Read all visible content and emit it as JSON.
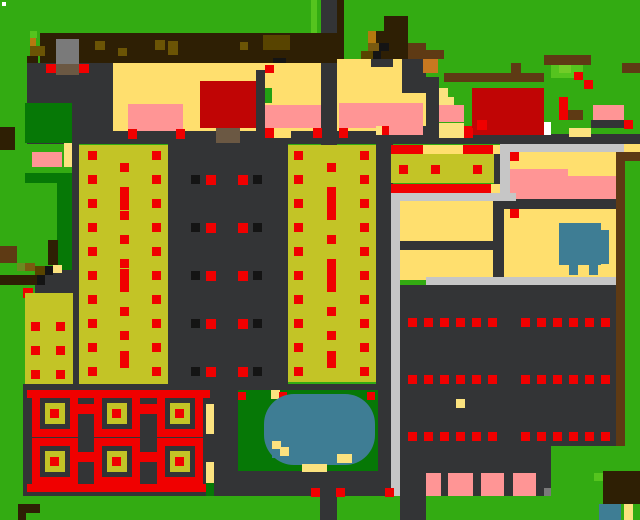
{
  "meta": {
    "kind": "pixel-farm-game-map",
    "width": 640,
    "height": 520
  },
  "palette": {
    "G": "#33AB12",
    "LG": "#55C41E",
    "LG2": "#72CC28",
    "GRN2": "#22A012",
    "DG": "#067806",
    "K": "#333436",
    "GRY": "#7A7A7A",
    "LGY": "#C6C6C6",
    "W": "#FFFFFF",
    "BK": "#141414",
    "Y": "#FFDF6E",
    "TAN": "#FBE27F",
    "O": "#C3C426",
    "OD2": "#584400",
    "OG": "#6B8A20",
    "P": "#FF9595",
    "R": "#F00000",
    "DR": "#C00505",
    "BD": "#2E1F04",
    "BR": "#5E3A14",
    "BM": "#6B5405",
    "BM2": "#7A5A10",
    "ORL": "#B5790F",
    "OR": "#C87820",
    "BAR": "#6B5843",
    "BL": "#3E7D94"
  },
  "rects": [
    [
      0,
      0,
      640,
      520,
      "G",
      "grass-background"
    ],
    [
      2,
      2,
      4,
      4,
      "W",
      "speck-white"
    ],
    [
      311,
      0,
      6,
      33,
      "LG",
      "light-grass-stripe"
    ],
    [
      321,
      0,
      16,
      146,
      "K",
      "road-vertical-top"
    ],
    [
      337,
      0,
      7,
      66,
      "BD",
      "trunk-strip"
    ],
    [
      40,
      33,
      297,
      30,
      "BD",
      "tilled-dirt-band"
    ],
    [
      30,
      31,
      7,
      7,
      "LG",
      "grass-speck"
    ],
    [
      30,
      38,
      6,
      8,
      "ORL",
      "dirt-speck"
    ],
    [
      30,
      46,
      15,
      10,
      "BM",
      "dirt-speck"
    ],
    [
      27,
      56,
      11,
      7,
      "BD",
      "dirt-speck"
    ],
    [
      30,
      63,
      7,
      11,
      "BK",
      "dirt-speck"
    ],
    [
      95,
      41,
      10,
      9,
      "BM",
      "dirt-speck"
    ],
    [
      118,
      48,
      9,
      8,
      "BM",
      "dirt-speck"
    ],
    [
      155,
      40,
      10,
      10,
      "BM",
      "dirt-speck"
    ],
    [
      168,
      41,
      10,
      14,
      "BM",
      "dirt-speck"
    ],
    [
      240,
      42,
      8,
      8,
      "BM",
      "dirt-speck"
    ],
    [
      263,
      35,
      27,
      15,
      "OD2",
      "dirt-patch"
    ],
    [
      273,
      58,
      13,
      5,
      "BK",
      "dirt-speck"
    ],
    [
      0,
      127,
      15,
      23,
      "BD",
      "left-edge-stump"
    ],
    [
      27,
      63,
      86,
      80,
      "K",
      "yard-dark-left"
    ],
    [
      56,
      39,
      23,
      26,
      "GRY",
      "shipping-bin"
    ],
    [
      56,
      64,
      23,
      11,
      "BAR",
      "shipping-bin-front"
    ],
    [
      46,
      64,
      10,
      9,
      "R",
      "red-dot"
    ],
    [
      79,
      64,
      10,
      9,
      "R",
      "red-dot"
    ],
    [
      113,
      63,
      208,
      68,
      "Y",
      "farmhouse-floor"
    ],
    [
      337,
      59,
      89,
      72,
      "Y",
      "house-right-floor"
    ],
    [
      371,
      59,
      22,
      8,
      "K",
      "wall-notch"
    ],
    [
      402,
      59,
      24,
      34,
      "K",
      "wall-notch"
    ],
    [
      423,
      59,
      15,
      14,
      "OR",
      "orange-crate"
    ],
    [
      384,
      16,
      24,
      15,
      "BD",
      "tree-canopy"
    ],
    [
      376,
      31,
      32,
      12,
      "BD",
      "tree-canopy"
    ],
    [
      368,
      31,
      8,
      12,
      "ORL",
      "tree-branch"
    ],
    [
      368,
      43,
      11,
      8,
      "BM2",
      "tree-branch"
    ],
    [
      379,
      43,
      10,
      8,
      "BK",
      "tree-shadow"
    ],
    [
      389,
      43,
      19,
      8,
      "BD",
      "tree-canopy"
    ],
    [
      361,
      51,
      12,
      8,
      "OD2",
      "tree-branch"
    ],
    [
      373,
      51,
      8,
      8,
      "BK",
      "tree-shadow"
    ],
    [
      381,
      51,
      27,
      8,
      "BD",
      "tree-canopy"
    ],
    [
      408,
      43,
      18,
      16,
      "BR",
      "fence-segment"
    ],
    [
      426,
      50,
      18,
      9,
      "BR",
      "fence-segment"
    ],
    [
      200,
      81,
      56,
      47,
      "DR",
      "red-building"
    ],
    [
      256,
      70,
      9,
      71,
      "K",
      "interior-wall"
    ],
    [
      265,
      65,
      9,
      8,
      "R",
      "red-dot"
    ],
    [
      128,
      104,
      55,
      27,
      "P",
      "pink-rug"
    ],
    [
      265,
      105,
      56,
      23,
      "P",
      "pink-rug"
    ],
    [
      339,
      103,
      84,
      25,
      "P",
      "pink-rug"
    ],
    [
      265,
      88,
      7,
      15,
      "GRN2",
      "green-door"
    ],
    [
      27,
      131,
      399,
      13,
      "K",
      "houses-baseline"
    ],
    [
      216,
      128,
      24,
      15,
      "BAR",
      "doormat"
    ],
    [
      273,
      128,
      18,
      10,
      "Y",
      "threshold"
    ],
    [
      128,
      129,
      9,
      10,
      "R",
      "red-dot"
    ],
    [
      176,
      129,
      9,
      10,
      "R",
      "red-dot"
    ],
    [
      265,
      128,
      9,
      10,
      "R",
      "red-dot"
    ],
    [
      313,
      128,
      9,
      10,
      "R",
      "red-dot"
    ],
    [
      339,
      128,
      9,
      10,
      "R",
      "red-dot"
    ],
    [
      386,
      128,
      9,
      10,
      "R",
      "red-dot"
    ],
    [
      25,
      103,
      47,
      40,
      "DG",
      "tree-block"
    ],
    [
      64,
      143,
      8,
      24,
      "TAN",
      "path-bit"
    ],
    [
      32,
      152,
      30,
      15,
      "P",
      "pink-bed"
    ],
    [
      25,
      173,
      47,
      10,
      "DG",
      "tree-block"
    ],
    [
      57,
      183,
      15,
      90,
      "DG",
      "tree-block"
    ],
    [
      35,
      270,
      45,
      23,
      "K",
      "tree-shade"
    ],
    [
      48,
      240,
      10,
      25,
      "BD",
      "tree-trunk"
    ],
    [
      0,
      246,
      17,
      17,
      "BR",
      "log"
    ],
    [
      17,
      263,
      8,
      8,
      "OG",
      "log-moss"
    ],
    [
      25,
      263,
      10,
      8,
      "BM2",
      "log"
    ],
    [
      35,
      266,
      10,
      9,
      "OD2",
      "log"
    ],
    [
      45,
      266,
      8,
      9,
      "BK",
      "log-shadow"
    ],
    [
      53,
      265,
      9,
      8,
      "TAN",
      "log-end"
    ],
    [
      0,
      275,
      37,
      10,
      "BD",
      "log"
    ],
    [
      37,
      275,
      8,
      10,
      "BK",
      "log-shadow"
    ],
    [
      72,
      143,
      7,
      241,
      "K",
      "path-strip"
    ],
    [
      79,
      145,
      89,
      239,
      "O",
      "crop-field-left"
    ],
    [
      168,
      143,
      120,
      249,
      "K",
      "dark-field"
    ],
    [
      288,
      145,
      88,
      237,
      "O",
      "crop-field-mid"
    ],
    [
      23,
      288,
      10,
      10,
      "R",
      "red-dot"
    ],
    [
      25,
      293,
      48,
      91,
      "O",
      "crop-field-small"
    ],
    [
      23,
      384,
      190,
      112,
      "K",
      "maze-ground"
    ],
    [
      210,
      384,
      183,
      112,
      "K",
      "pond-ground"
    ],
    [
      376,
      134,
      17,
      250,
      "K",
      "wall-vertical"
    ],
    [
      376,
      134,
      264,
      10,
      "K",
      "wall-horizontal"
    ],
    [
      376,
      126,
      6,
      9,
      "TAN",
      "edge-bit"
    ],
    [
      382,
      126,
      7,
      9,
      "R",
      "edge-bit"
    ],
    [
      389,
      126,
      34,
      9,
      "P",
      "edge-bit"
    ],
    [
      423,
      126,
      15,
      18,
      "K",
      "edge-block"
    ],
    [
      438,
      126,
      26,
      9,
      "P",
      "edge-bit"
    ],
    [
      464,
      126,
      9,
      9,
      "R",
      "edge-bit"
    ],
    [
      391,
      145,
      32,
      9,
      "R",
      "red-bar"
    ],
    [
      423,
      145,
      40,
      9,
      "Y",
      "yellow-bar"
    ],
    [
      463,
      145,
      30,
      9,
      "R",
      "red-bar"
    ],
    [
      493,
      145,
      7,
      9,
      "Y",
      "yellow-bar"
    ],
    [
      391,
      154,
      105,
      29,
      "O",
      "crop-field-right"
    ],
    [
      494,
      154,
      14,
      47,
      "K",
      "interior-wall"
    ],
    [
      391,
      184,
      100,
      9,
      "R",
      "red-bar"
    ],
    [
      491,
      184,
      9,
      9,
      "Y",
      "yellow-bar"
    ],
    [
      399,
      165,
      9,
      9,
      "R",
      "red-dot"
    ],
    [
      431,
      165,
      9,
      9,
      "R",
      "red-dot"
    ],
    [
      473,
      165,
      9,
      9,
      "R",
      "red-dot"
    ],
    [
      500,
      144,
      124,
      8,
      "LGY",
      "gray-path"
    ],
    [
      624,
      144,
      16,
      8,
      "Y",
      "corner-bit"
    ],
    [
      500,
      152,
      10,
      49,
      "LGY",
      "gray-path"
    ],
    [
      510,
      152,
      106,
      17,
      "Y",
      "room-floor"
    ],
    [
      568,
      169,
      48,
      7,
      "Y",
      "room-floor"
    ],
    [
      510,
      152,
      9,
      9,
      "R",
      "red-dot"
    ],
    [
      510,
      169,
      58,
      30,
      "P",
      "pink-room"
    ],
    [
      568,
      176,
      48,
      23,
      "P",
      "pink-room"
    ],
    [
      500,
      199,
      116,
      10,
      "K",
      "interior-wall"
    ],
    [
      391,
      193,
      125,
      8,
      "LGY",
      "gray-path"
    ],
    [
      400,
      201,
      93,
      40,
      "Y",
      "room-floor"
    ],
    [
      400,
      241,
      96,
      9,
      "K",
      "interior-wall"
    ],
    [
      400,
      250,
      93,
      30,
      "Y",
      "room-floor"
    ],
    [
      493,
      201,
      11,
      79,
      "K",
      "interior-wall"
    ],
    [
      504,
      209,
      112,
      68,
      "Y",
      "big-room-floor"
    ],
    [
      510,
      209,
      9,
      9,
      "R",
      "red-dot"
    ],
    [
      559,
      223,
      42,
      42,
      "BL",
      "truck-body"
    ],
    [
      601,
      230,
      8,
      34,
      "BL",
      "truck-cab"
    ],
    [
      569,
      265,
      9,
      10,
      "BL",
      "truck-wheel"
    ],
    [
      589,
      265,
      9,
      10,
      "BL",
      "truck-wheel"
    ],
    [
      426,
      277,
      190,
      8,
      "LGY",
      "gray-path"
    ],
    [
      393,
      285,
      224,
      161,
      "K",
      "warehouse-floor"
    ],
    [
      400,
      446,
      151,
      50,
      "K",
      "warehouse-floor"
    ],
    [
      391,
      201,
      9,
      296,
      "LGY",
      "gray-path-vertical"
    ],
    [
      616,
      152,
      9,
      294,
      "BR",
      "border-strip"
    ],
    [
      624,
      152,
      16,
      9,
      "BR",
      "border-bit"
    ],
    [
      456,
      399,
      9,
      9,
      "TAN",
      "speck"
    ],
    [
      426,
      473,
      15,
      23,
      "P",
      "pink-pallet"
    ],
    [
      448,
      473,
      25,
      23,
      "P",
      "pink-pallet"
    ],
    [
      481,
      473,
      23,
      23,
      "P",
      "pink-pallet"
    ],
    [
      513,
      473,
      23,
      23,
      "P",
      "pink-pallet"
    ],
    [
      544,
      488,
      7,
      8,
      "GRY",
      "speck"
    ],
    [
      444,
      73,
      100,
      9,
      "BR",
      "fence-long"
    ],
    [
      511,
      63,
      10,
      10,
      "BR",
      "fence-post"
    ],
    [
      544,
      55,
      47,
      10,
      "BR",
      "fence-pen"
    ],
    [
      551,
      65,
      32,
      13,
      "LG",
      "bush"
    ],
    [
      559,
      65,
      12,
      8,
      "LG2",
      "bush-light"
    ],
    [
      574,
      72,
      9,
      8,
      "R",
      "red-dot"
    ],
    [
      584,
      80,
      9,
      9,
      "R",
      "red-dot"
    ],
    [
      622,
      63,
      18,
      10,
      "BR",
      "fence-right"
    ],
    [
      426,
      77,
      13,
      63,
      "K",
      "ranch-wall"
    ],
    [
      439,
      88,
      9,
      12,
      "TAN",
      "ranch-bit"
    ],
    [
      439,
      97,
      15,
      8,
      "TAN",
      "ranch-bit"
    ],
    [
      439,
      105,
      25,
      17,
      "P",
      "pink-bed"
    ],
    [
      439,
      123,
      25,
      15,
      "TAN",
      "ranch-bit"
    ],
    [
      472,
      88,
      72,
      47,
      "DR",
      "barn"
    ],
    [
      477,
      120,
      10,
      10,
      "R",
      "red-dot"
    ],
    [
      544,
      122,
      7,
      13,
      "W",
      "barn-door"
    ],
    [
      464,
      128,
      9,
      10,
      "R",
      "red-dot"
    ],
    [
      559,
      97,
      9,
      23,
      "R",
      "totem-pole"
    ],
    [
      568,
      110,
      15,
      10,
      "BR",
      "totem-base"
    ],
    [
      593,
      105,
      31,
      15,
      "P",
      "feed-trough"
    ],
    [
      591,
      120,
      33,
      8,
      "K",
      "trough-shadow"
    ],
    [
      624,
      120,
      9,
      9,
      "R",
      "red-dot"
    ],
    [
      569,
      128,
      22,
      9,
      "TAN",
      "ranch-bit"
    ],
    [
      238,
      390,
      140,
      81,
      "DG",
      "pond-lawn"
    ],
    [
      271,
      390,
      9,
      9,
      "TAN",
      "sand-bit"
    ],
    [
      238,
      392,
      8,
      8,
      "R",
      "red-dot"
    ],
    [
      279,
      392,
      8,
      8,
      "R",
      "red-dot"
    ],
    [
      367,
      392,
      8,
      8,
      "R",
      "red-dot"
    ],
    [
      264,
      394,
      111,
      71,
      "BL",
      "pond",
      30
    ],
    [
      272,
      441,
      9,
      9,
      "TAN",
      "sand-bit"
    ],
    [
      280,
      447,
      9,
      9,
      "TAN",
      "sand-bit"
    ],
    [
      337,
      454,
      15,
      9,
      "TAN",
      "sand-bit"
    ],
    [
      302,
      464,
      25,
      8,
      "TAN",
      "sand-bit"
    ],
    [
      272,
      449,
      8,
      9,
      "BL",
      "water-bit"
    ],
    [
      0,
      496,
      640,
      24,
      "G",
      "grass-bottom"
    ],
    [
      320,
      472,
      17,
      48,
      "K",
      "road-vertical-bottom"
    ],
    [
      400,
      496,
      26,
      24,
      "K",
      "road-stub"
    ],
    [
      311,
      488,
      9,
      9,
      "R",
      "red-dot"
    ],
    [
      336,
      488,
      9,
      9,
      "R",
      "red-dot"
    ],
    [
      385,
      488,
      9,
      9,
      "R",
      "red-dot"
    ],
    [
      27,
      390,
      183,
      8,
      "R",
      "maze-bar-top"
    ],
    [
      27,
      484,
      183,
      8,
      "R",
      "maze-bar-bottom"
    ],
    [
      77,
      404,
      17,
      10,
      "R",
      "maze-tab"
    ],
    [
      140,
      404,
      17,
      10,
      "R",
      "maze-tab"
    ],
    [
      77,
      452,
      17,
      10,
      "R",
      "maze-tab"
    ],
    [
      140,
      452,
      17,
      10,
      "R",
      "maze-tab"
    ],
    [
      206,
      404,
      8,
      30,
      "TAN",
      "maze-edge-path"
    ],
    [
      206,
      462,
      8,
      24,
      "TAN",
      "maze-edge-path"
    ],
    [
      206,
      483,
      8,
      13,
      "DG",
      "maze-edge-green"
    ],
    [
      18,
      504,
      22,
      9,
      "BD",
      "bottom-log"
    ],
    [
      18,
      512,
      8,
      8,
      "BD",
      "bottom-log"
    ],
    [
      603,
      471,
      37,
      33,
      "BD",
      "stump-block"
    ],
    [
      594,
      473,
      9,
      8,
      "LG",
      "grass-speck"
    ],
    [
      599,
      504,
      22,
      16,
      "BL",
      "water-corner"
    ],
    [
      624,
      504,
      9,
      16,
      "TAN",
      "sand-corner"
    ],
    [
      120,
      191,
      9,
      19,
      "R",
      "tall-crop"
    ],
    [
      120,
      269,
      9,
      19,
      "R",
      "tall-crop"
    ],
    [
      120,
      351,
      9,
      17,
      "R",
      "tall-crop"
    ],
    [
      327,
      192,
      9,
      19,
      "R",
      "tall-crop"
    ],
    [
      327,
      267,
      9,
      19,
      "R",
      "tall-crop"
    ],
    [
      327,
      351,
      9,
      17,
      "R",
      "tall-crop"
    ]
  ],
  "dot_grids": [
    {
      "x": 88,
      "y": 151,
      "dx": 64,
      "dy": 24,
      "nx": 2,
      "ny": 10,
      "w": 9,
      "h": 9,
      "c": "R",
      "name": "crop-dots-left"
    },
    {
      "x": 120,
      "y": 163,
      "dx": 0,
      "dy": 24,
      "nx": 1,
      "ny": 9,
      "w": 9,
      "h": 9,
      "c": "R",
      "name": "crop-dots-left-mid"
    },
    {
      "x": 294,
      "y": 151,
      "dx": 66,
      "dy": 24,
      "nx": 2,
      "ny": 10,
      "w": 9,
      "h": 9,
      "c": "R",
      "name": "crop-dots-mid"
    },
    {
      "x": 327,
      "y": 163,
      "dx": 0,
      "dy": 24,
      "nx": 1,
      "ny": 9,
      "w": 9,
      "h": 9,
      "c": "R",
      "name": "crop-dots-mid-mid"
    },
    {
      "x": 191,
      "y": 175,
      "dx": 62,
      "dy": 48,
      "nx": 2,
      "ny": 5,
      "w": 9,
      "h": 9,
      "c": "BK",
      "name": "dark-field-black-dot"
    },
    {
      "x": 206,
      "y": 175,
      "dx": 32,
      "dy": 48,
      "nx": 2,
      "ny": 5,
      "w": 10,
      "h": 10,
      "c": "R",
      "name": "dark-field-red-dot"
    },
    {
      "x": 31,
      "y": 322,
      "dx": 25,
      "dy": 24,
      "nx": 2,
      "ny": 3,
      "w": 9,
      "h": 9,
      "c": "R",
      "name": "crop-dots-small"
    },
    {
      "x": 408,
      "y": 318,
      "dx": 16,
      "dy": 57,
      "nx": 6,
      "ny": 3,
      "w": 9,
      "h": 9,
      "c": "R",
      "name": "warehouse-dot"
    },
    {
      "x": 521,
      "y": 318,
      "dx": 16,
      "dy": 57,
      "nx": 6,
      "ny": 3,
      "w": 9,
      "h": 9,
      "c": "R",
      "name": "warehouse-dot"
    }
  ],
  "maze": {
    "cols": [
      32,
      94,
      157
    ],
    "rows": [
      390,
      438
    ],
    "cell_w": 46,
    "cell_h": 47,
    "ring_t": 8,
    "gap_t": 5,
    "dot_s": 9,
    "ring": "R",
    "inner": "K",
    "center": "O",
    "dot": "R",
    "name": "garden-maze-cell"
  }
}
